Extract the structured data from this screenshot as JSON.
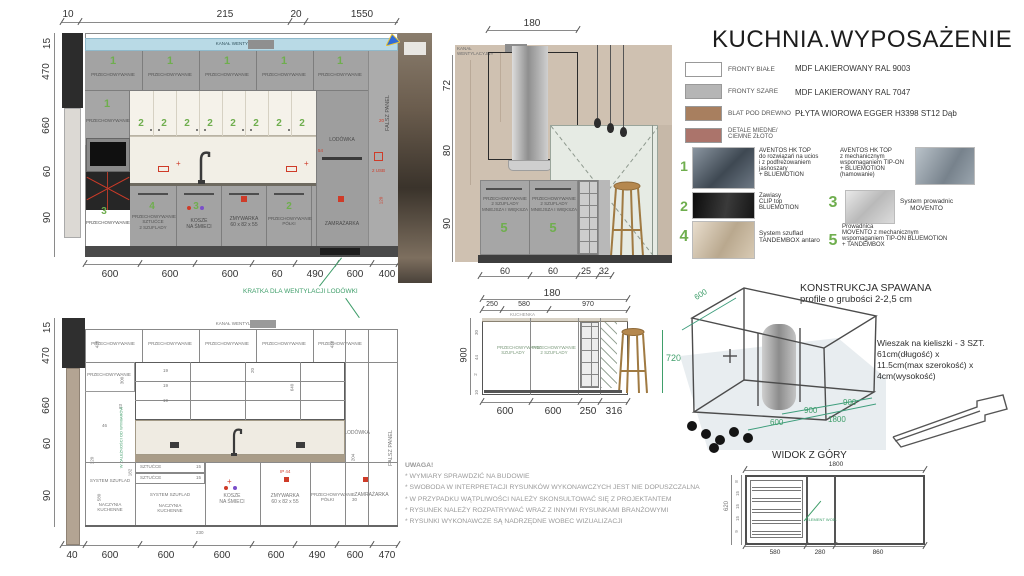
{
  "title": "KUCHNIA.WYPOSAŻENIE",
  "legend": {
    "rows": [
      {
        "label": "FRONTY BIAŁE",
        "desc": "MDF LAKIEROWANY RAL 9003",
        "color": "#ffffff"
      },
      {
        "label": "FRONTY SZARE",
        "desc": "MDF LAKIEROWANY RAL 7047",
        "color": "#b5b5b5"
      },
      {
        "label": "BLAT POD DREWNO",
        "desc": "PŁYTA WIOROWA EGGER H3398 ST12 Dąb",
        "color": "#a87f5f"
      },
      {
        "label": "DETALE MIEDNE/\nCIEMNE ZŁOTO",
        "desc": "",
        "color": "#ab746b"
      }
    ]
  },
  "hardware": {
    "green": "#6fae4e",
    "n1": "1",
    "t1": "AVENTOS HK TOP\ndo rozwiązań na ucios\ni z podfrezowaniem\njasnoszary\n+ BLUEMOTION",
    "t1b": "AVENTOS HK TOP\nz mechanicznym\nwspomaganiem TIP-ON\n+ BLUEMOTION\n(hamowanie)",
    "n2": "2",
    "t2": "Zawiasy\nCLIP top\nBLUEMOTION",
    "n3": "3",
    "t3": "System prowadnic\nMOVENTO",
    "n4": "4",
    "t4": "System szuflad\nTANDEMBOX antaro",
    "n5": "5",
    "t5": "Prowadnica\n MOVENTO z mechanicznym\nwspomaganiem TIP-ON BLUEMOTION\n+ TANDEMBOX"
  },
  "labels": {
    "storage": "PRZECHOWYWANIE",
    "vent": "KANAŁ WENTYLACYJNY",
    "fridge": "LODÓWKA",
    "false_panel": "FALSZ PANEL",
    "freezer": "ZAMRAŻARKA",
    "dishwasher": "ZMYWARKA\n60 x 82 x 55",
    "bins": "KOSZE\nNA ŚMIECI",
    "drawers_unit": "SYSTEM SZUFLAD",
    "kitchenware": "NACZYNIA\nKUCHENNE",
    "cutlery": "SZTUĆCE",
    "storage_shelves": "PRZECHOWYWANIE\nPÓŁKI",
    "storage_cutlery": "PRZECHOWYWANIE\nSZTUĆCE\n2 SZUFLADY",
    "storage_island": "PRZECHOWYWANIE\n2 SZUFLADY\nMNIEJSZA I WIĘKSZA",
    "storage_drawers": "PRZECHOWYWANIE\nSZUFLADY",
    "storage_2drawers": "PRZECHOWYWANIE\n2 SZUFLADY",
    "vent_grille_note": "KRATKA DLA WENTYLACJI LODÓWKI",
    "cooker": "KUCHENKA",
    "depends_note": "W ZALEŻNOŚCI OD WYMIARÓW"
  },
  "elev1": {
    "top_dims": [
      "10",
      "215",
      "20",
      "1550"
    ],
    "left_dims": [
      "15",
      "470",
      "660",
      "60",
      "90"
    ],
    "bottom_dims": [
      "600",
      "600",
      "600",
      "60",
      "490",
      "600",
      "400"
    ],
    "nums": {
      "upper": "1",
      "doors": "2",
      "c1": "3",
      "c2": "4",
      "c3": "3",
      "c5": "2"
    },
    "blue_dim": "150",
    "red_marks": {
      "a": "54",
      "b": "20",
      "c": "2 USB",
      "d": "120"
    }
  },
  "elev2": {
    "top_dim": "180",
    "left_dims": [
      "72",
      "80",
      "90"
    ],
    "bottom_dims": [
      "60",
      "60",
      "25",
      "32"
    ],
    "num": "5"
  },
  "elev3": {
    "left_dims": [
      "15",
      "470",
      "660",
      "60",
      "90"
    ],
    "bottom_dims": [
      "40",
      "600",
      "600",
      "600",
      "600",
      "490",
      "600",
      "470"
    ],
    "inner": {
      "a": "438",
      "b": "438",
      "c": "300",
      "d": "23",
      "e": "19",
      "f": "19",
      "g": "19",
      "h": "640",
      "i": "20",
      "j": "46",
      "k": "120",
      "l": "182",
      "m": "580",
      "n": "230",
      "o": "204",
      "p": "30",
      "q": "15",
      "r": "15"
    },
    "ip": "IP 44"
  },
  "section": {
    "shared_total": "180",
    "top_dims": [
      "250",
      "580",
      "970"
    ],
    "left_dim": "900",
    "right_dim": "720",
    "bottom_dims": [
      "600",
      "600",
      "250",
      "316"
    ],
    "inner_dims": [
      "30",
      "44",
      "2",
      "10"
    ]
  },
  "construction": {
    "title": "KONSTRUKCJA SPAWANA",
    "subtitle": "profile o grubości 2-2,5 cm",
    "d600_top": "600",
    "d900a": "900",
    "d900b": "900",
    "d600b": "600",
    "d1800": "1800",
    "hanger_note": "Wieszak na kieliszki - 3 SZT.\n61cm(długość) x\n 11.5cm(max szerokość) x\n4cm(wysokość)"
  },
  "topview": {
    "title": "WIDOK Z GÓRY",
    "top_dim": "1800",
    "bottom_dims": [
      "580",
      "280",
      "860"
    ],
    "left_dims": [
      "8",
      "15",
      "15",
      "15",
      "9"
    ],
    "left_total": "620",
    "inner_label": "ELEMENT WOD."
  },
  "notes": {
    "heading": "UWAGA!",
    "lines": [
      "* WYMIARY SPRAWDZIĆ NA BUDOWIE",
      "* SWOBODA W INTERPRETACJI RYSUNKÓW WYKONAWCZYCH JEST NIE DOPUSZCZALNA",
      "* W PRZYPADKU WĄTPLIWOŚCI NALEŻY SKONSULTOWAĆ SIĘ Z PROJEKTANTEM",
      "* RYSUNEK NALEŻY ROZPATRYWAĆ WRAZ Z INNYMI RYSUNKAMI BRANŻOWYMI",
      "* RYSUNKI WYKONAWCZE SĄ NADRZĘDNE WOBEC WIZUALIZACJI"
    ]
  }
}
